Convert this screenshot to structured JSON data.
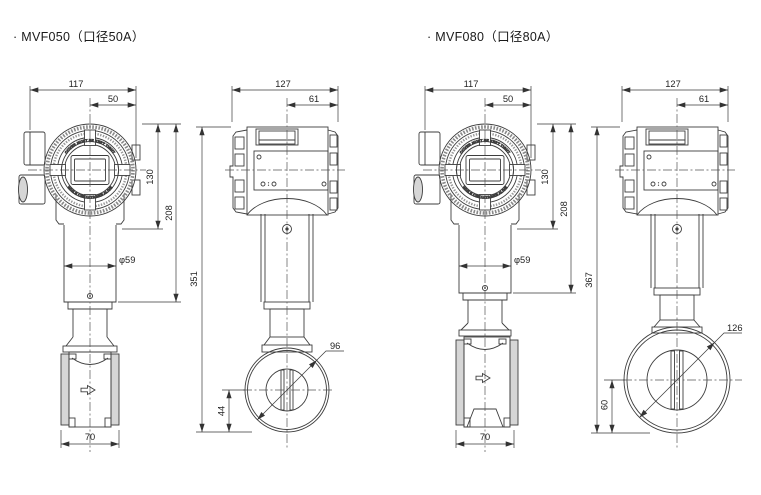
{
  "drawing": {
    "line_color": "#3d3d3d",
    "fill_gray": "#d6d6d6",
    "background": "#ffffff"
  },
  "head_ring": {
    "top_text": "COVER MUST BE KEPT TIGHT",
    "bottom_text": "WHILE CIRCUITS ARE ALIVE"
  },
  "sections": [
    {
      "id": "mvf050",
      "title": "· MVF050（口径50A）",
      "front": {
        "w": "117",
        "w_half": "50",
        "h_housing": "130",
        "h_neck": "208",
        "neck_dia": "φ59",
        "body_w": "70"
      },
      "side": {
        "w": "127",
        "w_half": "61",
        "h_total": "351",
        "body_dia": "96",
        "disc_offset": "44"
      }
    },
    {
      "id": "mvf080",
      "title": "· MVF080（口径80A）",
      "front": {
        "w": "117",
        "w_half": "50",
        "h_housing": "130",
        "h_neck": "208",
        "neck_dia": "φ59",
        "body_w": "70"
      },
      "side": {
        "w": "127",
        "w_half": "61",
        "h_total": "367",
        "body_dia": "126",
        "disc_offset": "60"
      }
    }
  ]
}
